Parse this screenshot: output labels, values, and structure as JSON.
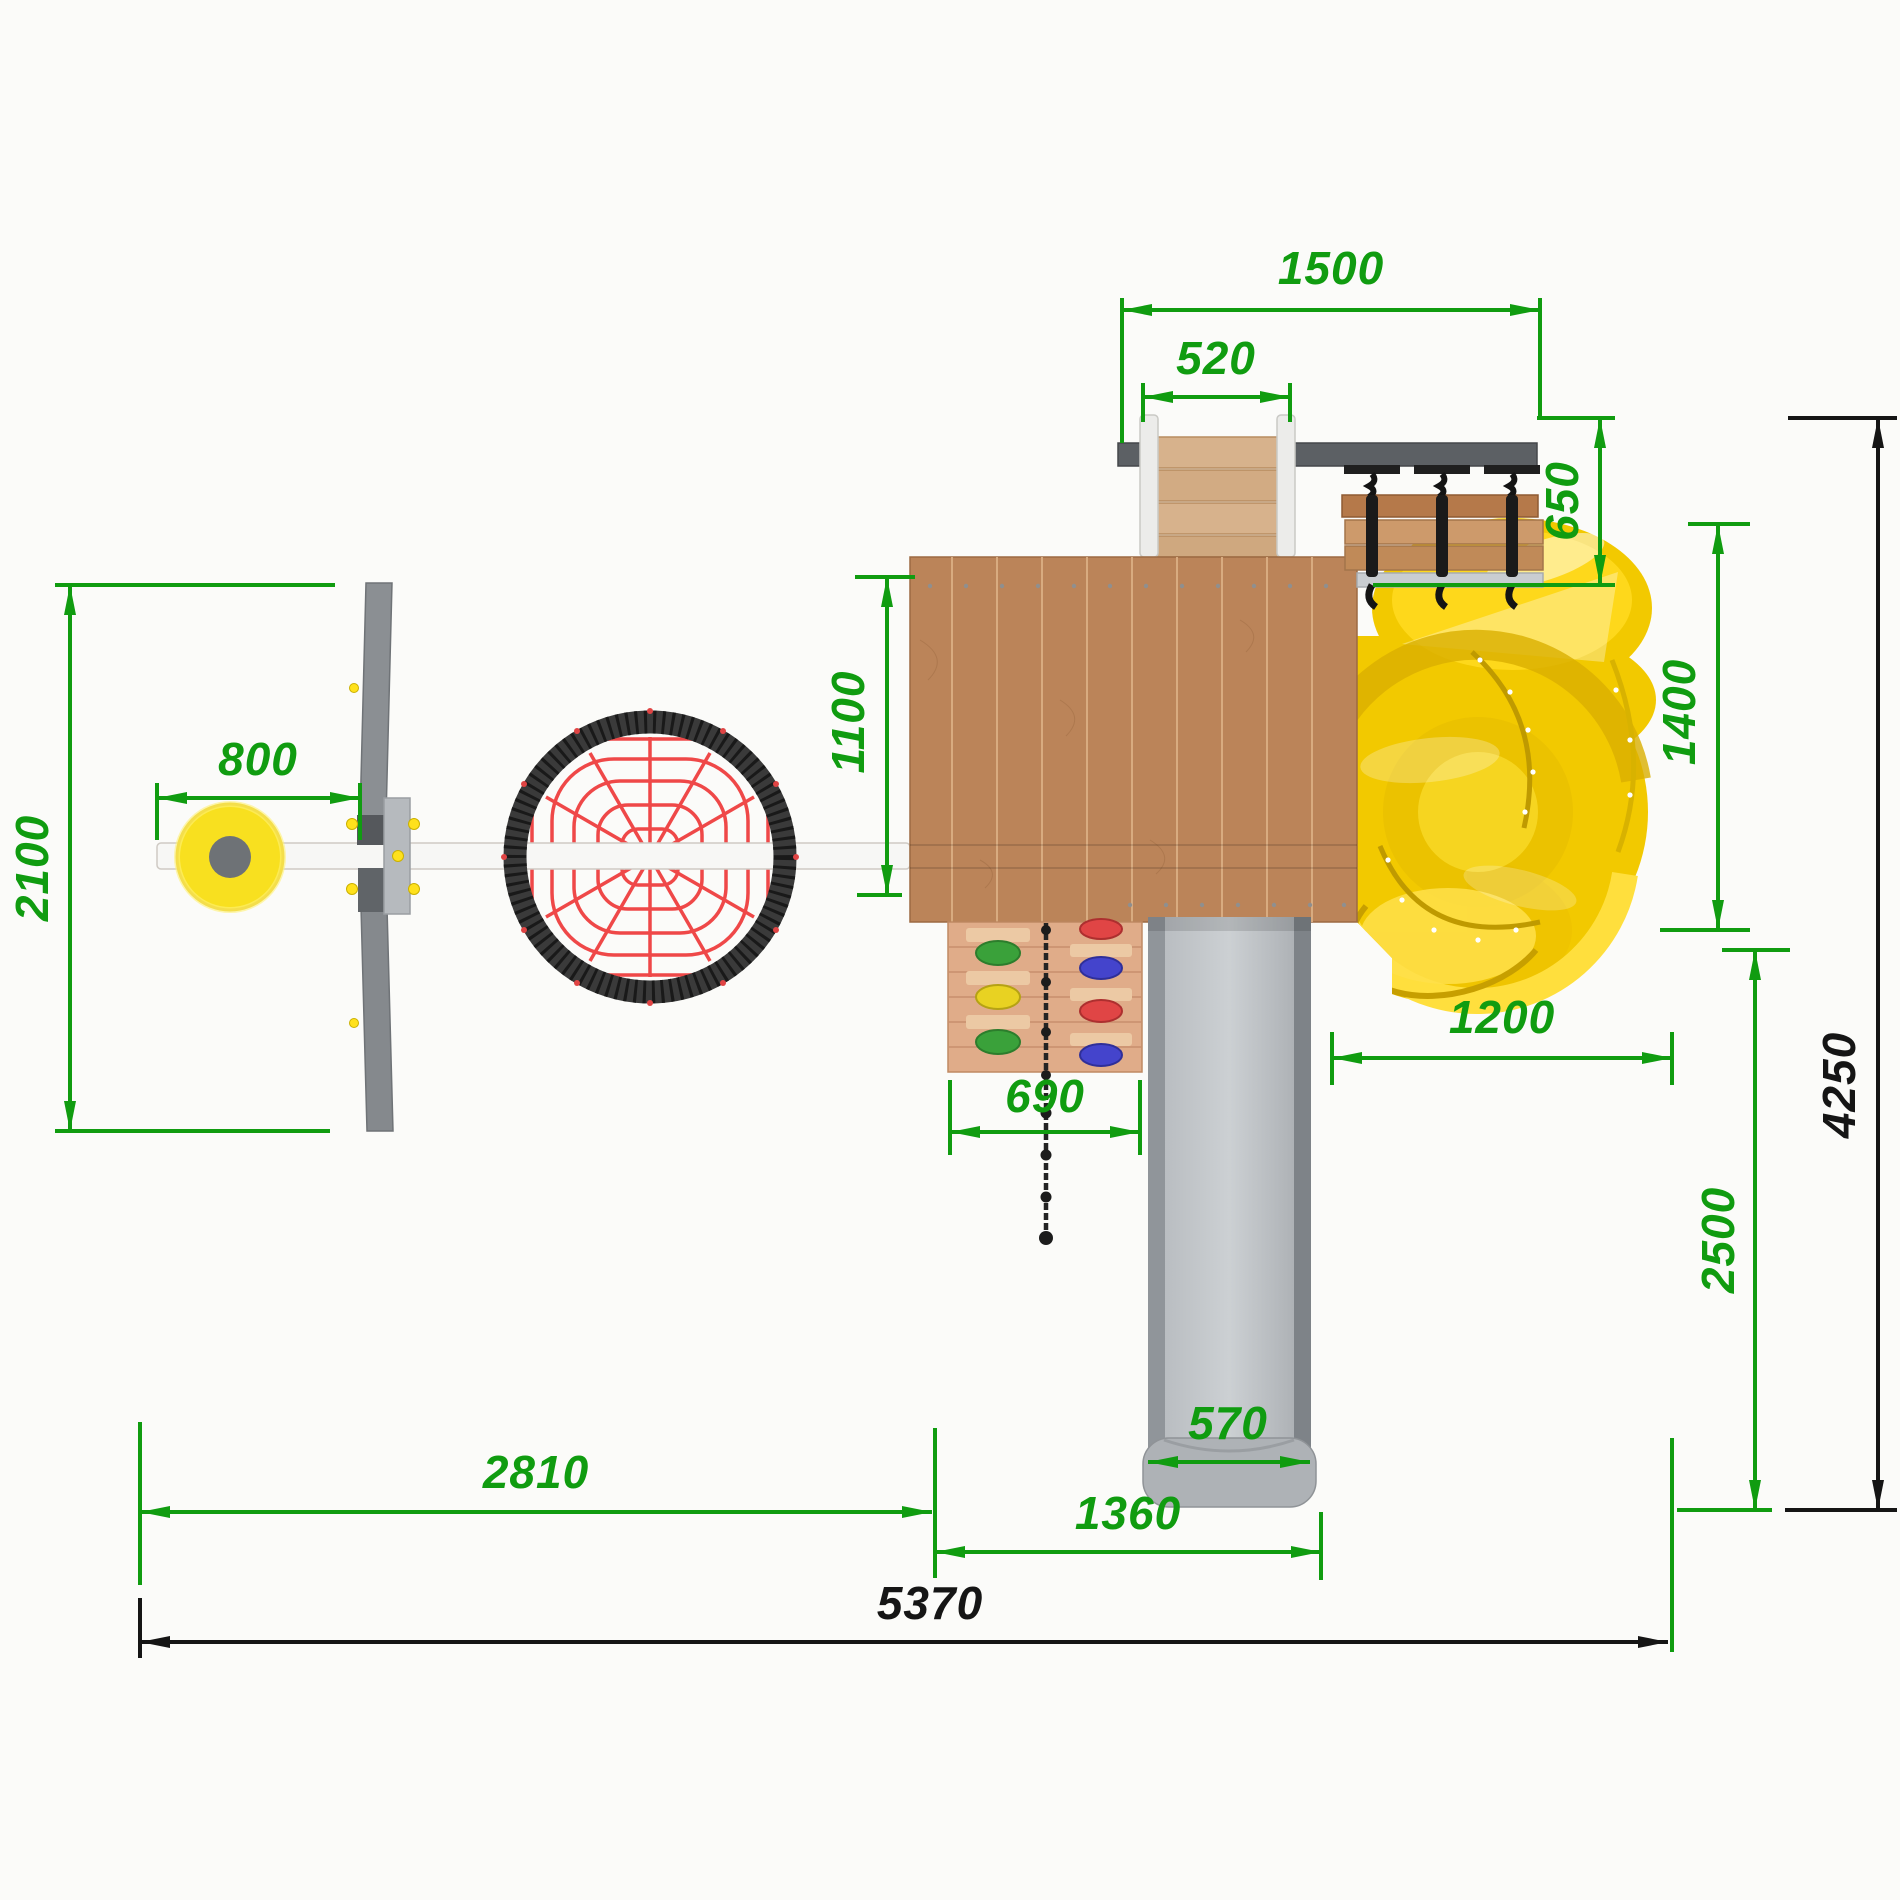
{
  "drawing": {
    "type": "top-view dimensioned drawing of playground structure",
    "units": "mm",
    "colors": {
      "dimension_green": "#109c10",
      "dimension_black": "#151515",
      "slide_yellow": "#f2c900",
      "wood_platform": "#bb8459",
      "wood_light": "#d3a06e",
      "metal_gray": "#9aa0a4",
      "net_red": "#ef4848",
      "net_rim": "#3a3a3a",
      "seat_yellow": "#f8e01f"
    },
    "components": [
      "swing-beam",
      "swing-seat",
      "swing-frame",
      "net-climber",
      "platform",
      "entry-ladder",
      "monkey-bar-beam",
      "hanging-bridge",
      "spiral-tube-slide",
      "straight-slide",
      "climbing-wall",
      "climbing-rope"
    ]
  },
  "dims": {
    "d1500": "1500",
    "d520": "520",
    "d650": "650",
    "d1400": "1400",
    "d2500": "2500",
    "d4250": "4250",
    "d2100": "2100",
    "d800": "800",
    "d1100": "1100",
    "d690": "690",
    "d1200": "1200",
    "d570": "570",
    "d1360": "1360",
    "d2810": "2810",
    "d5370": "5370"
  }
}
